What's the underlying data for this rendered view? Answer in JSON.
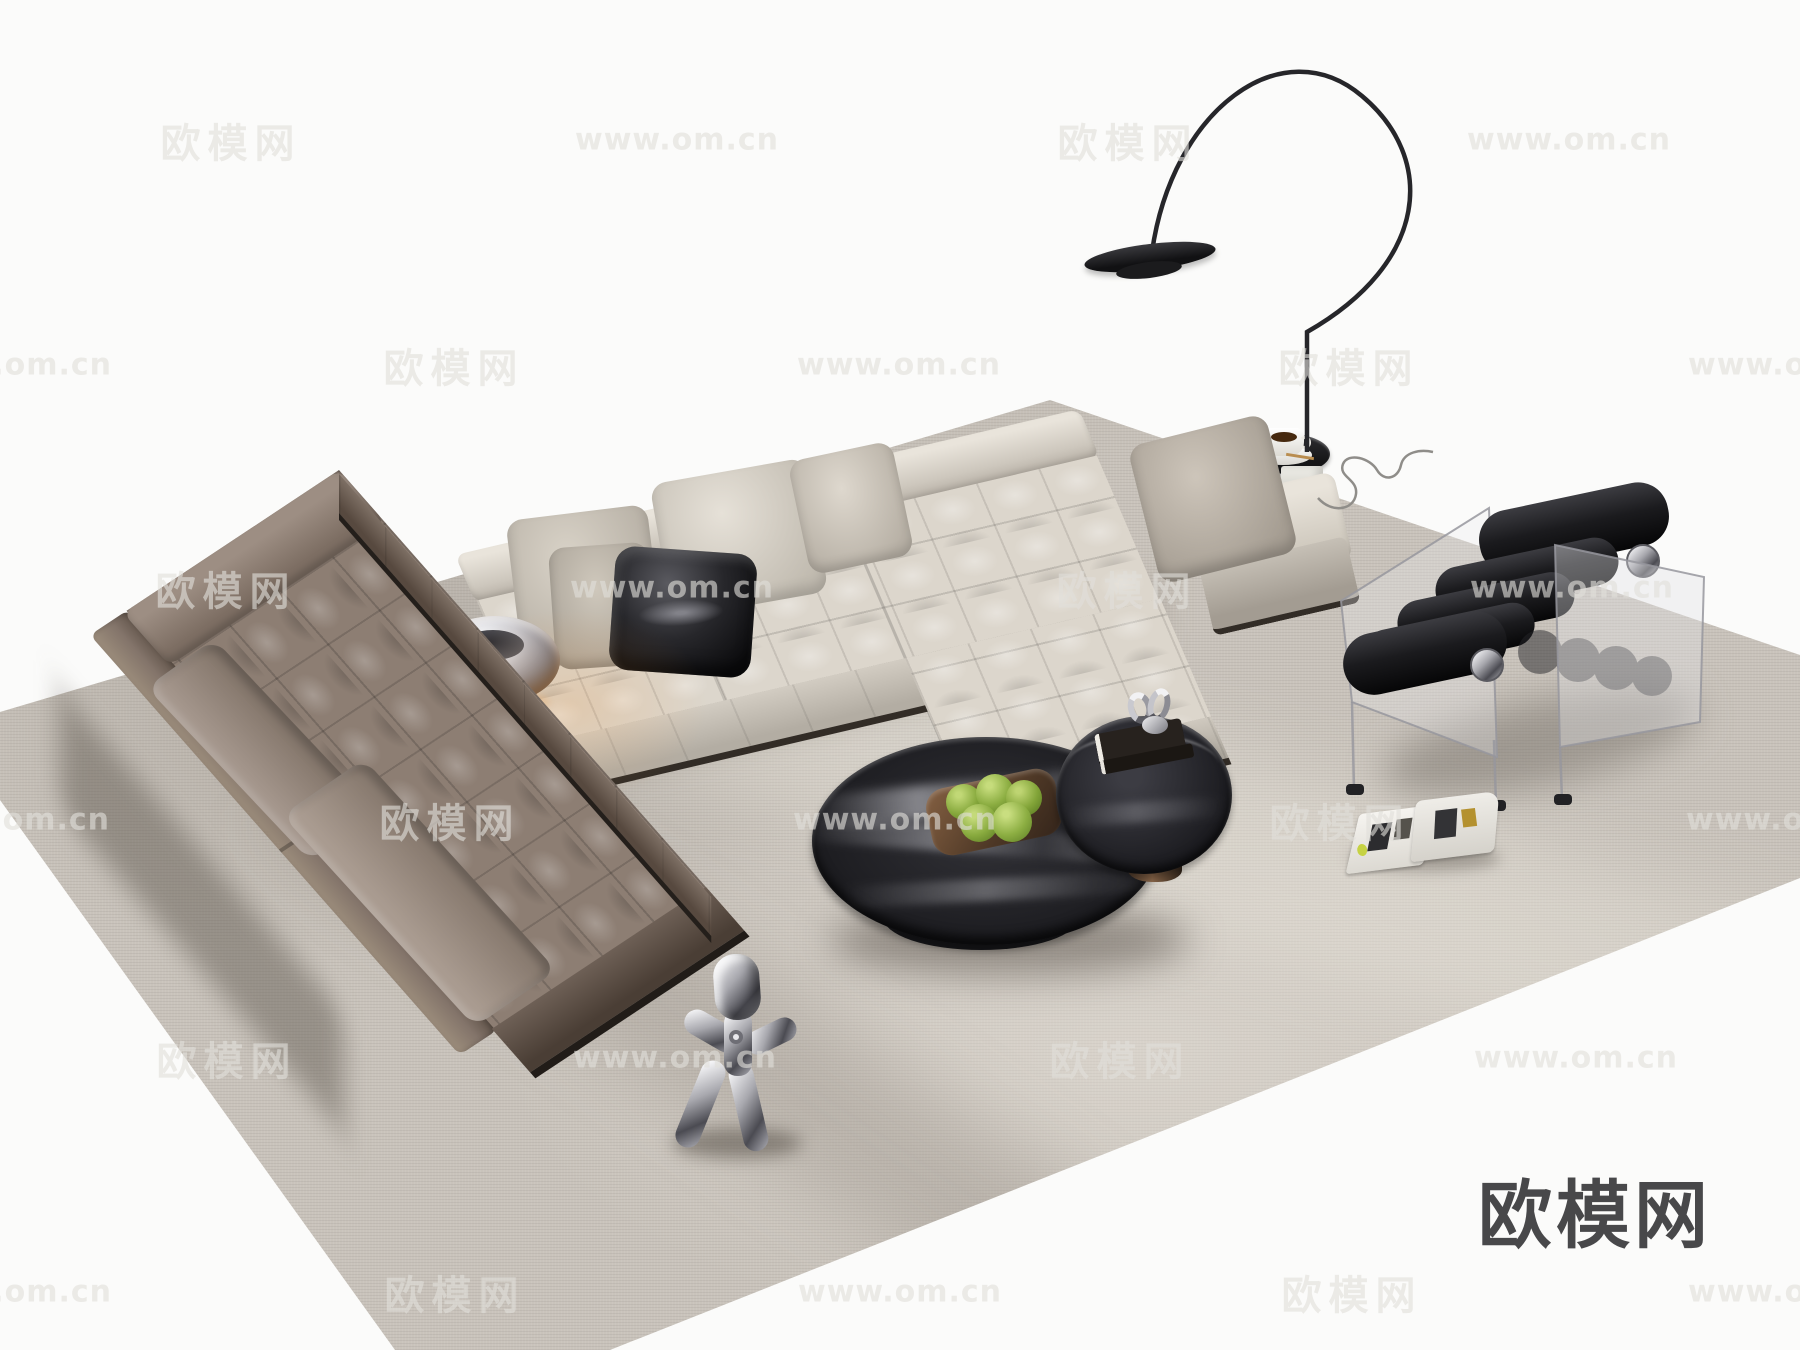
{
  "site": {
    "name": "欧模网",
    "url": "www.om.cn"
  },
  "logo": {
    "text": "欧模网",
    "color": "#48484a"
  },
  "watermark": {
    "brand_text": "欧模网",
    "url_text": "www.om.cn",
    "color": "rgba(225,223,218,0.62)",
    "rows": [
      {
        "y": 140,
        "items": [
          {
            "x": 231,
            "t": "brand"
          },
          {
            "x": 677,
            "t": "url"
          },
          {
            "x": 1128,
            "t": "brand"
          },
          {
            "x": 1569,
            "t": "url"
          }
        ]
      },
      {
        "y": 365,
        "items": [
          {
            "x": 10,
            "t": "url"
          },
          {
            "x": 454,
            "t": "brand"
          },
          {
            "x": 899,
            "t": "url"
          },
          {
            "x": 1349,
            "t": "brand"
          },
          {
            "x": 1790,
            "t": "url"
          }
        ]
      },
      {
        "y": 588,
        "items": [
          {
            "x": 226,
            "t": "brand"
          },
          {
            "x": 672,
            "t": "url"
          },
          {
            "x": 1127,
            "t": "brand"
          },
          {
            "x": 1572,
            "t": "url"
          }
        ]
      },
      {
        "y": 820,
        "items": [
          {
            "x": 8,
            "t": "url"
          },
          {
            "x": 450,
            "t": "brand"
          },
          {
            "x": 895,
            "t": "url"
          },
          {
            "x": 1340,
            "t": "brand"
          },
          {
            "x": 1788,
            "t": "url"
          }
        ]
      },
      {
        "y": 1058,
        "items": [
          {
            "x": 227,
            "t": "brand"
          },
          {
            "x": 675,
            "t": "url"
          },
          {
            "x": 1120,
            "t": "brand"
          },
          {
            "x": 1576,
            "t": "url"
          }
        ]
      },
      {
        "y": 1292,
        "items": [
          {
            "x": 10,
            "t": "url"
          },
          {
            "x": 455,
            "t": "brand"
          },
          {
            "x": 900,
            "t": "url"
          },
          {
            "x": 1352,
            "t": "brand"
          },
          {
            "x": 1790,
            "t": "url"
          }
        ]
      }
    ]
  },
  "palette": {
    "floor": "#fbfbfa",
    "carpet": "#c9c3bb",
    "sofa-cream": "#dcd6cc",
    "sofa-brown": "#8d7e73",
    "console-bronze": "#8a5a30",
    "chair-black": "#1a1a1d",
    "marble": "#232327",
    "apple-green": "#83a738",
    "chrome": "#a8a8ae",
    "plinth": "#322c26"
  },
  "scene": {
    "description": "Minimal living-room 3D render: cream tufted sectional sofa with chaise, taupe tufted chaise sofa, bronze console with chrome mushroom lamp, black marble round nesting coffee tables with tray of green apples, black roller lounge chair with clear acrylic sides, arc floor lamp with round side table and coffee cup, chrome walking-figure sculpture, open magazine on a grey rug",
    "items": [
      {
        "name": "cream-sectional-sofa",
        "color": "#dcd6cc"
      },
      {
        "name": "taupe-chaise-sofa",
        "color": "#8d7e73"
      },
      {
        "name": "bronze-console-table",
        "color": "#8a5a30"
      },
      {
        "name": "chrome-mushroom-lamp",
        "color": "#c9c9ce"
      },
      {
        "name": "marble-coffee-table-large",
        "color": "#232327"
      },
      {
        "name": "glass-coffee-table-small",
        "color": "#2c2c32"
      },
      {
        "name": "fruit-tray-green-apples",
        "color": "#83a738"
      },
      {
        "name": "acrylic-roll-lounge-chair",
        "color": "#1a1a1d"
      },
      {
        "name": "arc-floor-lamp",
        "color": "#26262a"
      },
      {
        "name": "side-table-with-coffee-cup",
        "color": "#1d1d1f"
      },
      {
        "name": "chrome-figure-sculpture",
        "color": "#b5b5bb"
      },
      {
        "name": "open-magazine",
        "color": "#f3f1ec"
      },
      {
        "name": "grey-area-rug",
        "color": "#c9c3bb"
      }
    ]
  }
}
